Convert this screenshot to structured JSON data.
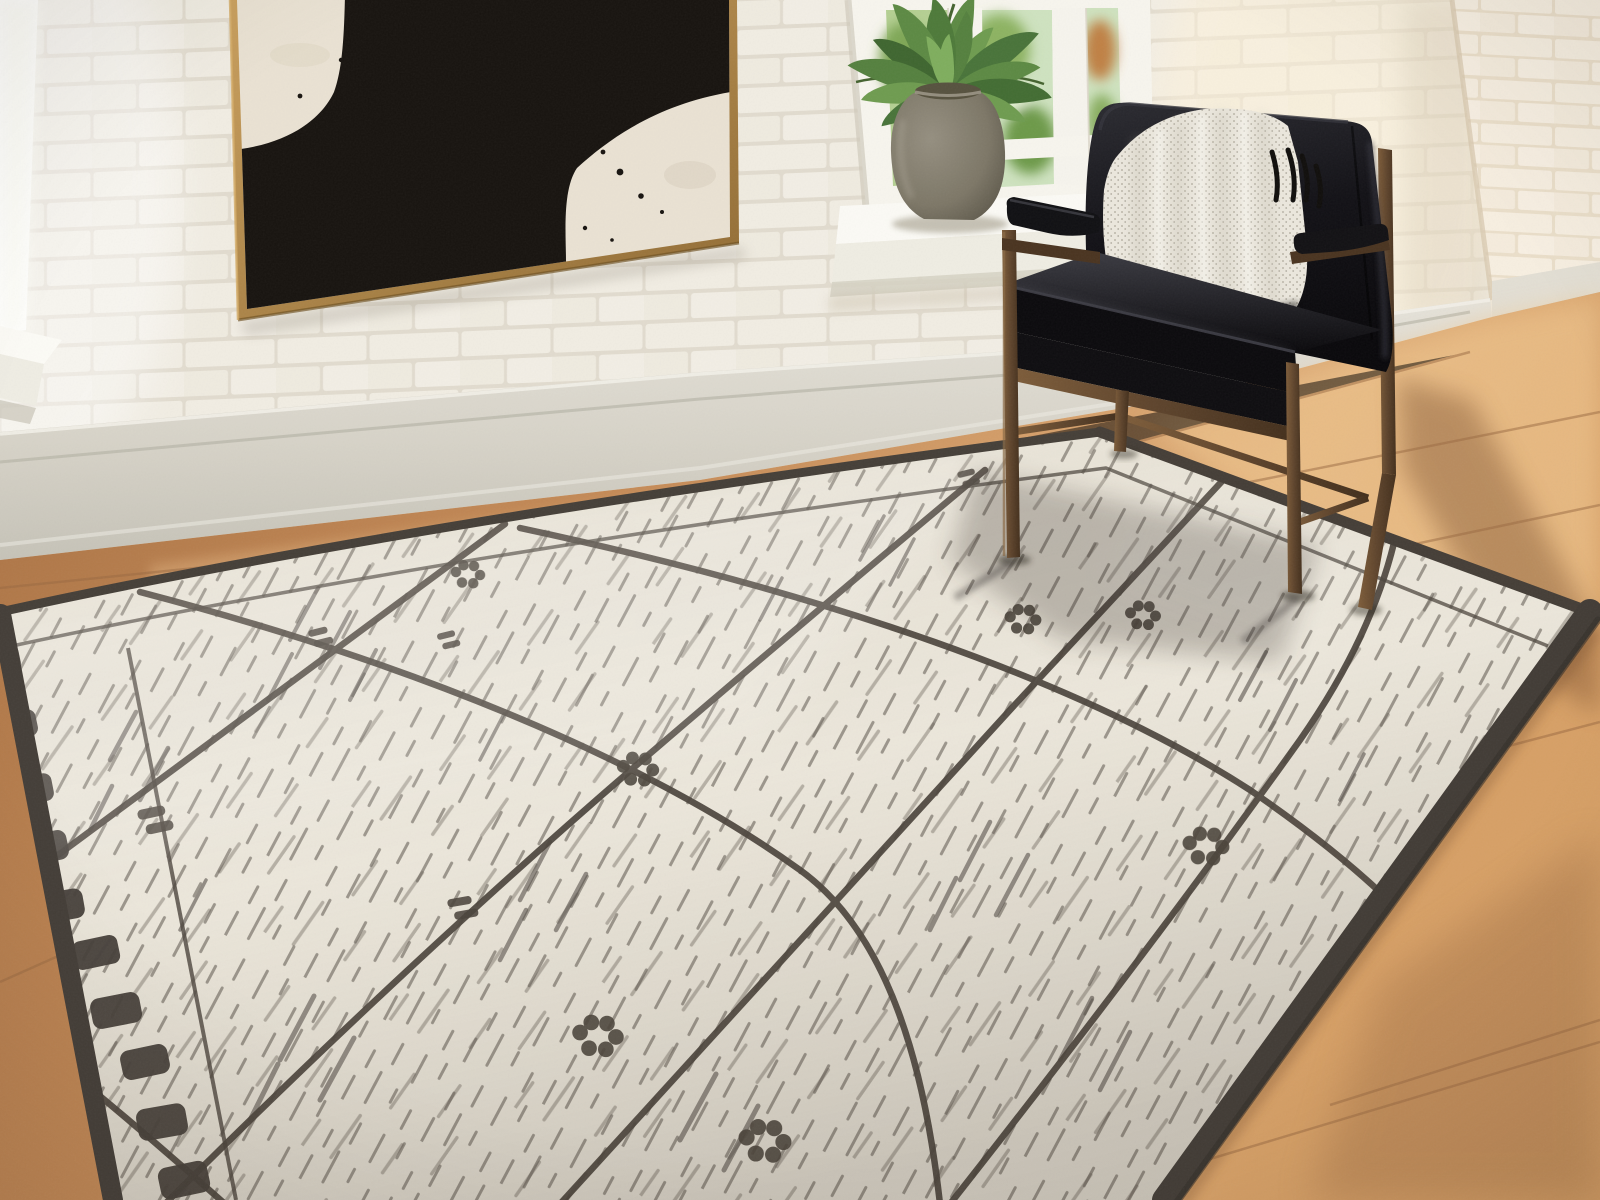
{
  "scene": {
    "label": "Sunlit room corner: black leather accent chair with ivory throw on a distressed Moroccan-style area rug against white painted brick walls",
    "objects": [
      {
        "name": "brick-wall-front",
        "desc": "white painted brick wall"
      },
      {
        "name": "brick-wall-right",
        "desc": "cream painted brick side wall"
      },
      {
        "name": "abstract-painting",
        "desc": "black and cream abstract canvas in thin gold frame"
      },
      {
        "name": "window-left",
        "desc": "bright window at far left with white sill"
      },
      {
        "name": "window-center",
        "desc": "white window with green foliage outside"
      },
      {
        "name": "potted-plant",
        "desc": "green plant in gray ceramic urn on window sill"
      },
      {
        "name": "accent-chair",
        "desc": "black faux-leather chair with bronze metal frame"
      },
      {
        "name": "throw-blanket",
        "desc": "ivory boucle throw with black fringe"
      },
      {
        "name": "area-rug",
        "desc": "ivory rug with charcoal diamond lattice, flower motifs and dark border"
      },
      {
        "name": "wood-floor",
        "desc": "light oak plank floor with sun patches"
      },
      {
        "name": "baseboard",
        "desc": "greige painted baseboard moulding"
      }
    ]
  },
  "palette": {
    "wall_brick": "#f1ede3",
    "wall_mortar": "#e2dccf",
    "wall_right_brick": "#f7efe1",
    "wall_right_mortar": "#ebdfca",
    "baseboard": "#d9d5ca",
    "floor_mid": "#c68c58",
    "floor_light": "#e8bd8a",
    "floor_dark": "#9d6a3f",
    "rug_field": "#ece7db",
    "rug_ink": "#4b443c",
    "rug_binding": "#453f38",
    "frame_gold": "#b3894a",
    "canvas_cream": "#eae2d3",
    "paint_black": "#181410",
    "chair_leather": "#121114",
    "chair_bronze": "#5e442c",
    "throw_ivory": "#ebe7dd",
    "vase_gray": "#847e6e",
    "leaf_green": "#5d8a44",
    "glass_green": "#b5d093"
  }
}
